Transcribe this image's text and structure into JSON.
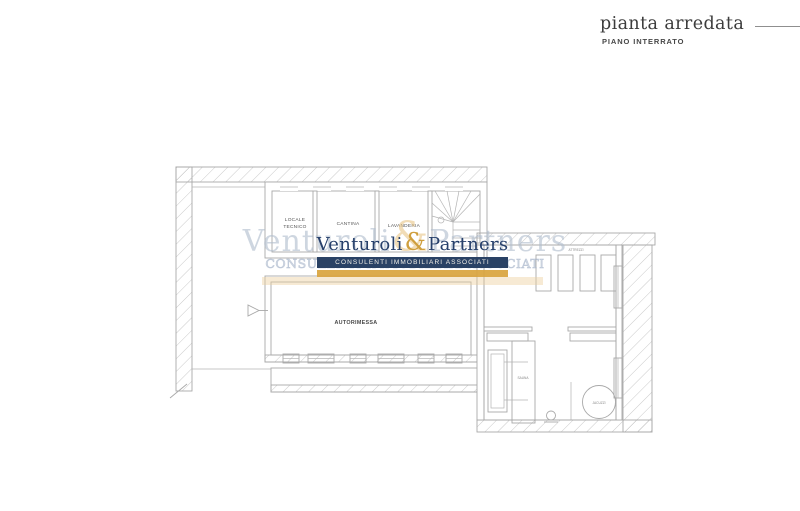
{
  "title_block": {
    "title": "pianta arredata",
    "subtitle": "PIANO INTERRATO"
  },
  "watermark": {
    "name_left": "Venturoli",
    "ampersand": "&",
    "name_right": "Partners",
    "tagline": "CONSULENTI IMMOBILIARI ASSOCIATI",
    "navy_color": "#2a4265",
    "gold_color": "#d9a53e"
  },
  "plan": {
    "line_color": "#a9a9a9",
    "labels": {
      "locale_tecnico_line1": "LOCALE",
      "locale_tecnico_line2": "TECNICO",
      "cantina": "CANTINA",
      "lavanderia": "LAVANDERIA",
      "autorimessa": "AUTORIMESSA",
      "attrezzi": "ATTREZZI",
      "sauna": "SAUNA",
      "jacuzzi": "JACUZZI"
    }
  }
}
